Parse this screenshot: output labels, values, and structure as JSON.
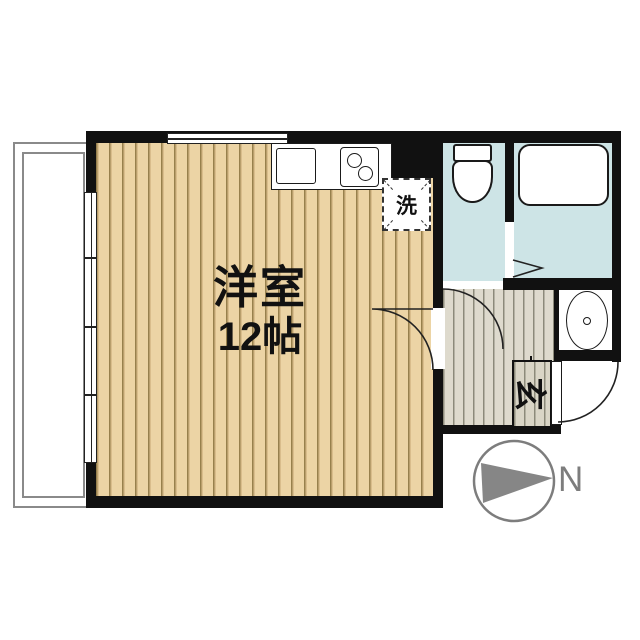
{
  "plan_type": "apartment-floor-plan",
  "rooms": {
    "western_room": {
      "name": "洋室",
      "size": "12帖"
    },
    "laundry": {
      "label": "洗"
    },
    "entrance": {
      "label": "玄"
    }
  },
  "compass": {
    "north_label": "N"
  },
  "colors": {
    "wall": "#111111",
    "wood_floor": "#ecd4a5",
    "wood_stripe": "#97804d",
    "hall_floor": "#dedacd",
    "hall_stripe": "#8c8a7a",
    "wet_area": "#cde4e6",
    "compass_gray": "#7d7d7d"
  }
}
